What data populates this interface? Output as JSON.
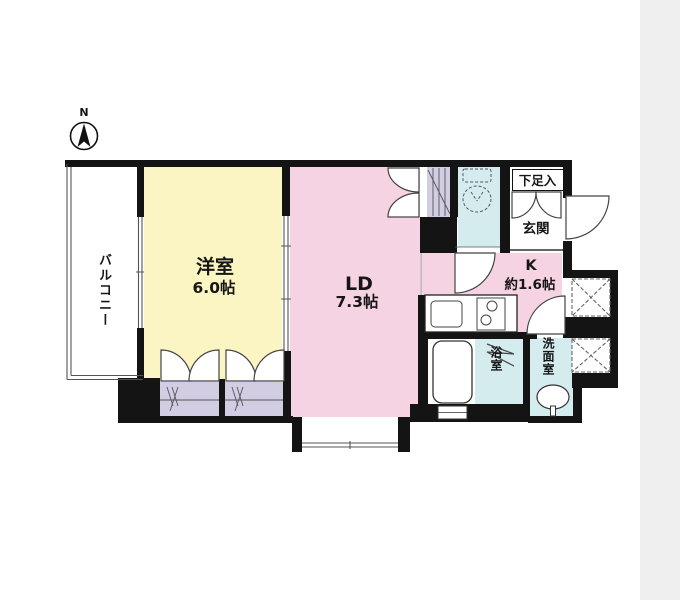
{
  "compass": {
    "north_label": "N"
  },
  "rooms": {
    "balcony": {
      "label": "バルコニー"
    },
    "western_room": {
      "label": "洋室",
      "size": "6.0帖"
    },
    "living_dining": {
      "label": "LD",
      "size": "7.3帖"
    },
    "kitchen": {
      "label": "K",
      "size": "約1.6帖"
    },
    "entrance": {
      "label": "玄関"
    },
    "shoe_storage": {
      "label": "下足入"
    },
    "bathroom": {
      "label": "浴室"
    },
    "washroom": {
      "label": "洗面室"
    }
  },
  "colors": {
    "western_room_fill": "#faf5c3",
    "living_dining_fill": "#f6d3e2",
    "kitchen_fill": "#f6d3e2",
    "wet_area_fill": "#d4ecee",
    "closet_fill": "#d3cde4",
    "wall": "#141414",
    "page_margin": "#efefef"
  }
}
